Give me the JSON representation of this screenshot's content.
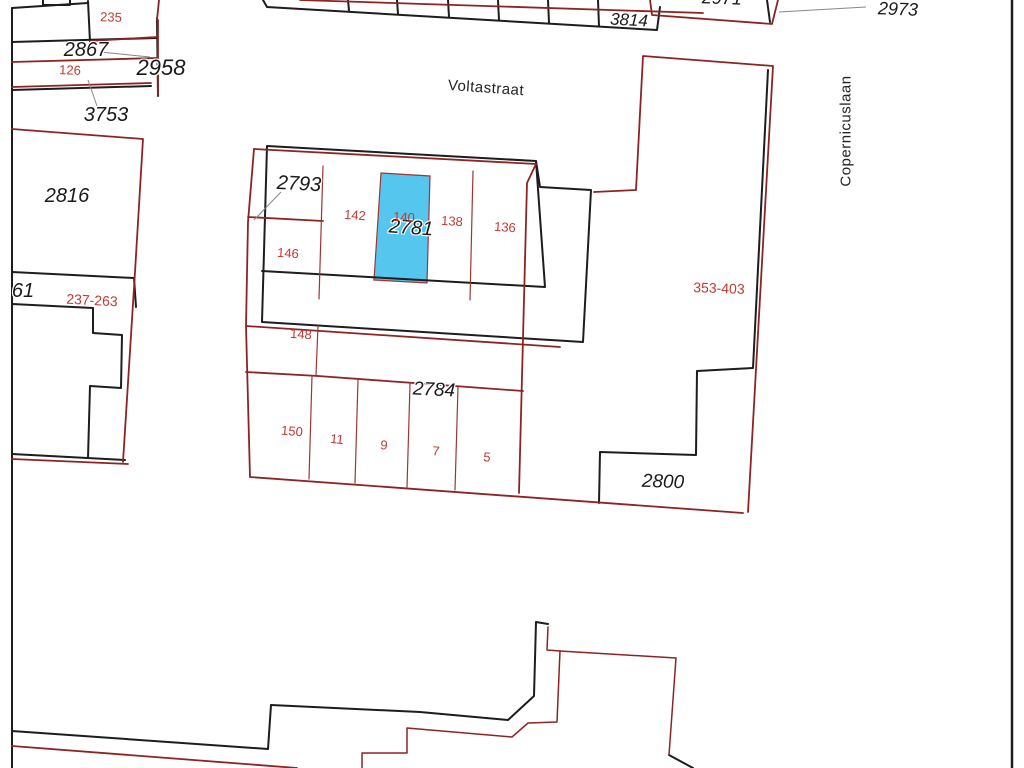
{
  "map": {
    "type": "cadastral parcel map",
    "streets": {
      "voltastraat": {
        "name": "Voltastraat"
      },
      "copernicuslaan": {
        "name": "Copernicuslaan"
      }
    },
    "highlighted_parcel": {
      "parcel_number": "2781",
      "house_number": "140",
      "fill_color": "#55c6ee"
    },
    "colors": {
      "boundary_black": "#1d1d1d",
      "boundary_dark_red": "#8d2423",
      "division_red": "#9d3632",
      "label_red": "#c13a32",
      "label_black": "#1a1a1a",
      "leader_gray": "#888888",
      "highlight_blue": "#55c6ee"
    },
    "labels": {
      "p2958": {
        "text": "2958"
      },
      "p2867": {
        "text": "2867"
      },
      "p3753": {
        "text": "3753"
      },
      "p2816": {
        "text": "2816"
      },
      "p61": {
        "text": "61"
      },
      "p3814": {
        "text": "3814"
      },
      "p2971": {
        "text": "2971"
      },
      "p2973": {
        "text": "2973"
      },
      "p2793": {
        "text": "2793"
      },
      "p2781": {
        "text": "2781"
      },
      "p2784": {
        "text": "2784"
      },
      "p2800": {
        "text": "2800"
      },
      "h235": {
        "text": "235"
      },
      "h126": {
        "text": "126"
      },
      "h237263": {
        "text": "237-263"
      },
      "h142": {
        "text": "142"
      },
      "h140": {
        "text": "140"
      },
      "h138": {
        "text": "138"
      },
      "h136": {
        "text": "136"
      },
      "h146": {
        "text": "146"
      },
      "h148": {
        "text": "148"
      },
      "h353403": {
        "text": "353-403"
      },
      "h150": {
        "text": "150"
      },
      "h11": {
        "text": "11"
      },
      "h9": {
        "text": "9"
      },
      "h7": {
        "text": "7"
      },
      "h5": {
        "text": "5"
      }
    }
  }
}
